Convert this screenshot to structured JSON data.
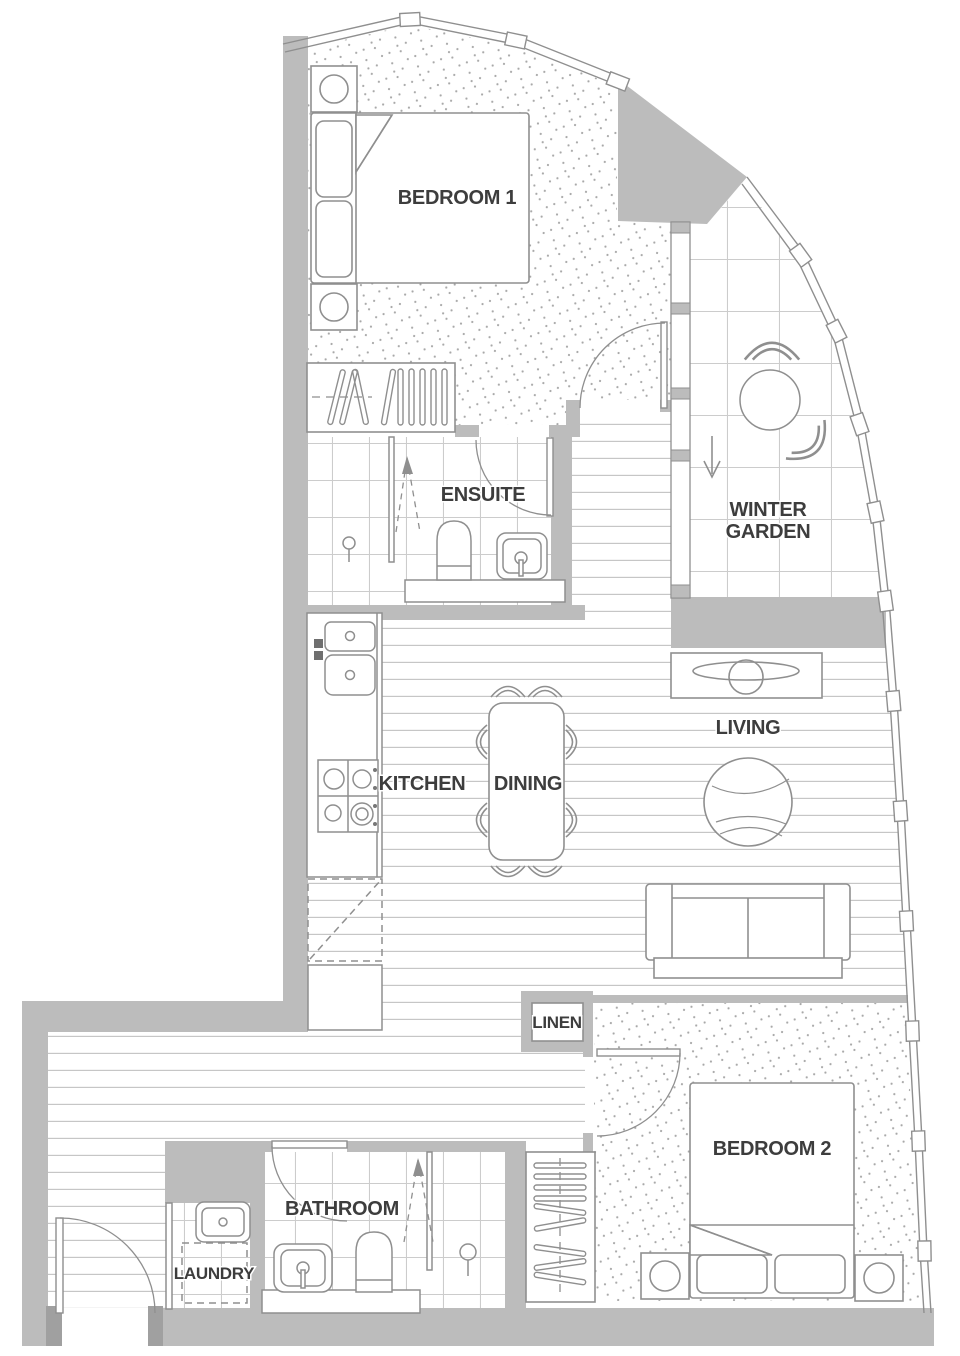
{
  "plan": {
    "rooms": {
      "bedroom1": "BEDROOM 1",
      "ensuite": "ENSUITE",
      "winter_garden_line1": "WINTER",
      "winter_garden_line2": "GARDEN",
      "kitchen": "KITCHEN",
      "dining": "DINING",
      "living": "LIVING",
      "linen": "LINEN",
      "bedroom2": "BEDROOM 2",
      "bathroom": "BATHROOM",
      "laundry": "LAUNDRY"
    },
    "colors": {
      "wall_fill": "#bcbcbc",
      "jamb_fill": "#a0a0a0",
      "line": "#8f8f8f",
      "text": "#3d3d3d",
      "floor_line": "#c6c6c6",
      "tile_line": "#cccccc",
      "stipple_dot": "#a8a8a8",
      "background": "#ffffff"
    }
  }
}
